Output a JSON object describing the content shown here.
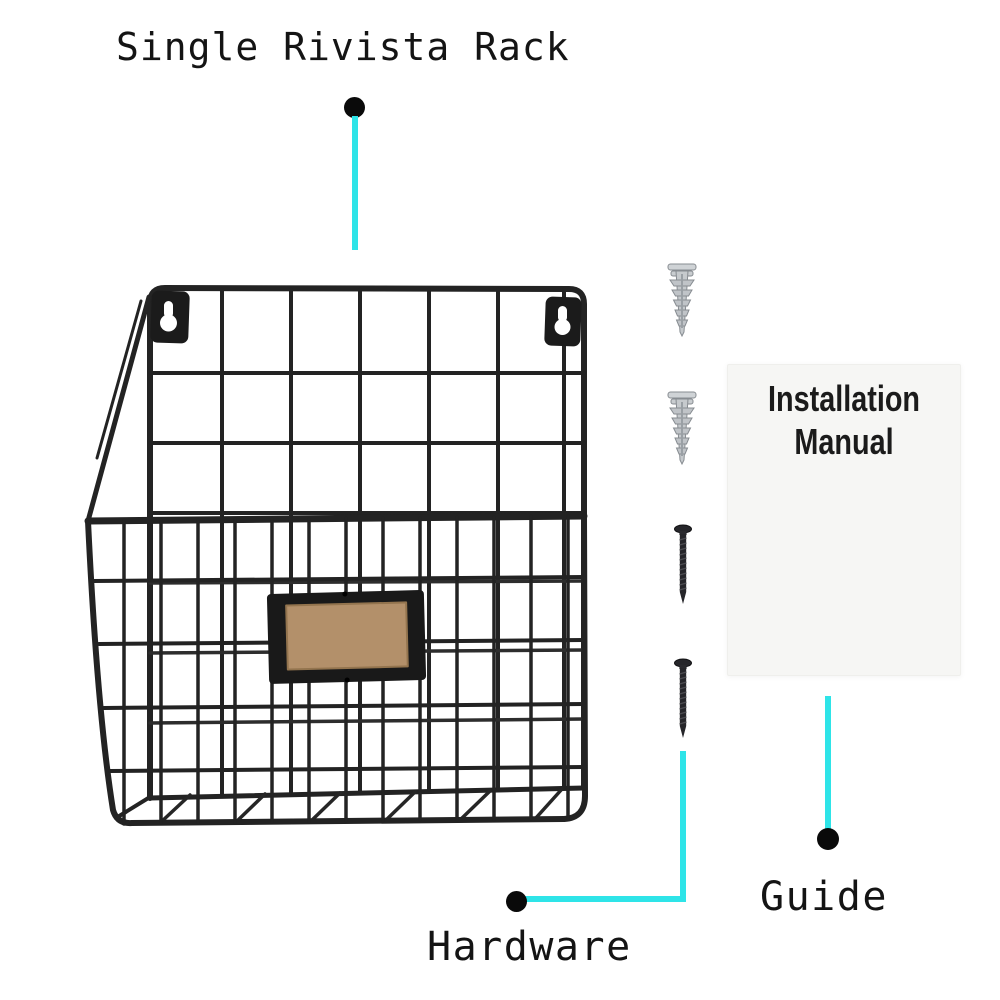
{
  "product": {
    "title": "Single Rivista Rack"
  },
  "callouts": {
    "hardware": {
      "label": "Hardware"
    },
    "guide": {
      "label": "Guide"
    },
    "manual": {
      "line1": "Installation",
      "line2": "Manual"
    }
  },
  "hardware_items": {
    "wall_anchor_count": 2,
    "screw_count": 2
  },
  "colors": {
    "background": "#ffffff",
    "callout_line": "#2ee4e8",
    "callout_dot": "#0a0a0a",
    "wire": "#232323",
    "label_card": "#b3906a",
    "manual_sheet": "#f6f6f4",
    "text": "#141414"
  }
}
